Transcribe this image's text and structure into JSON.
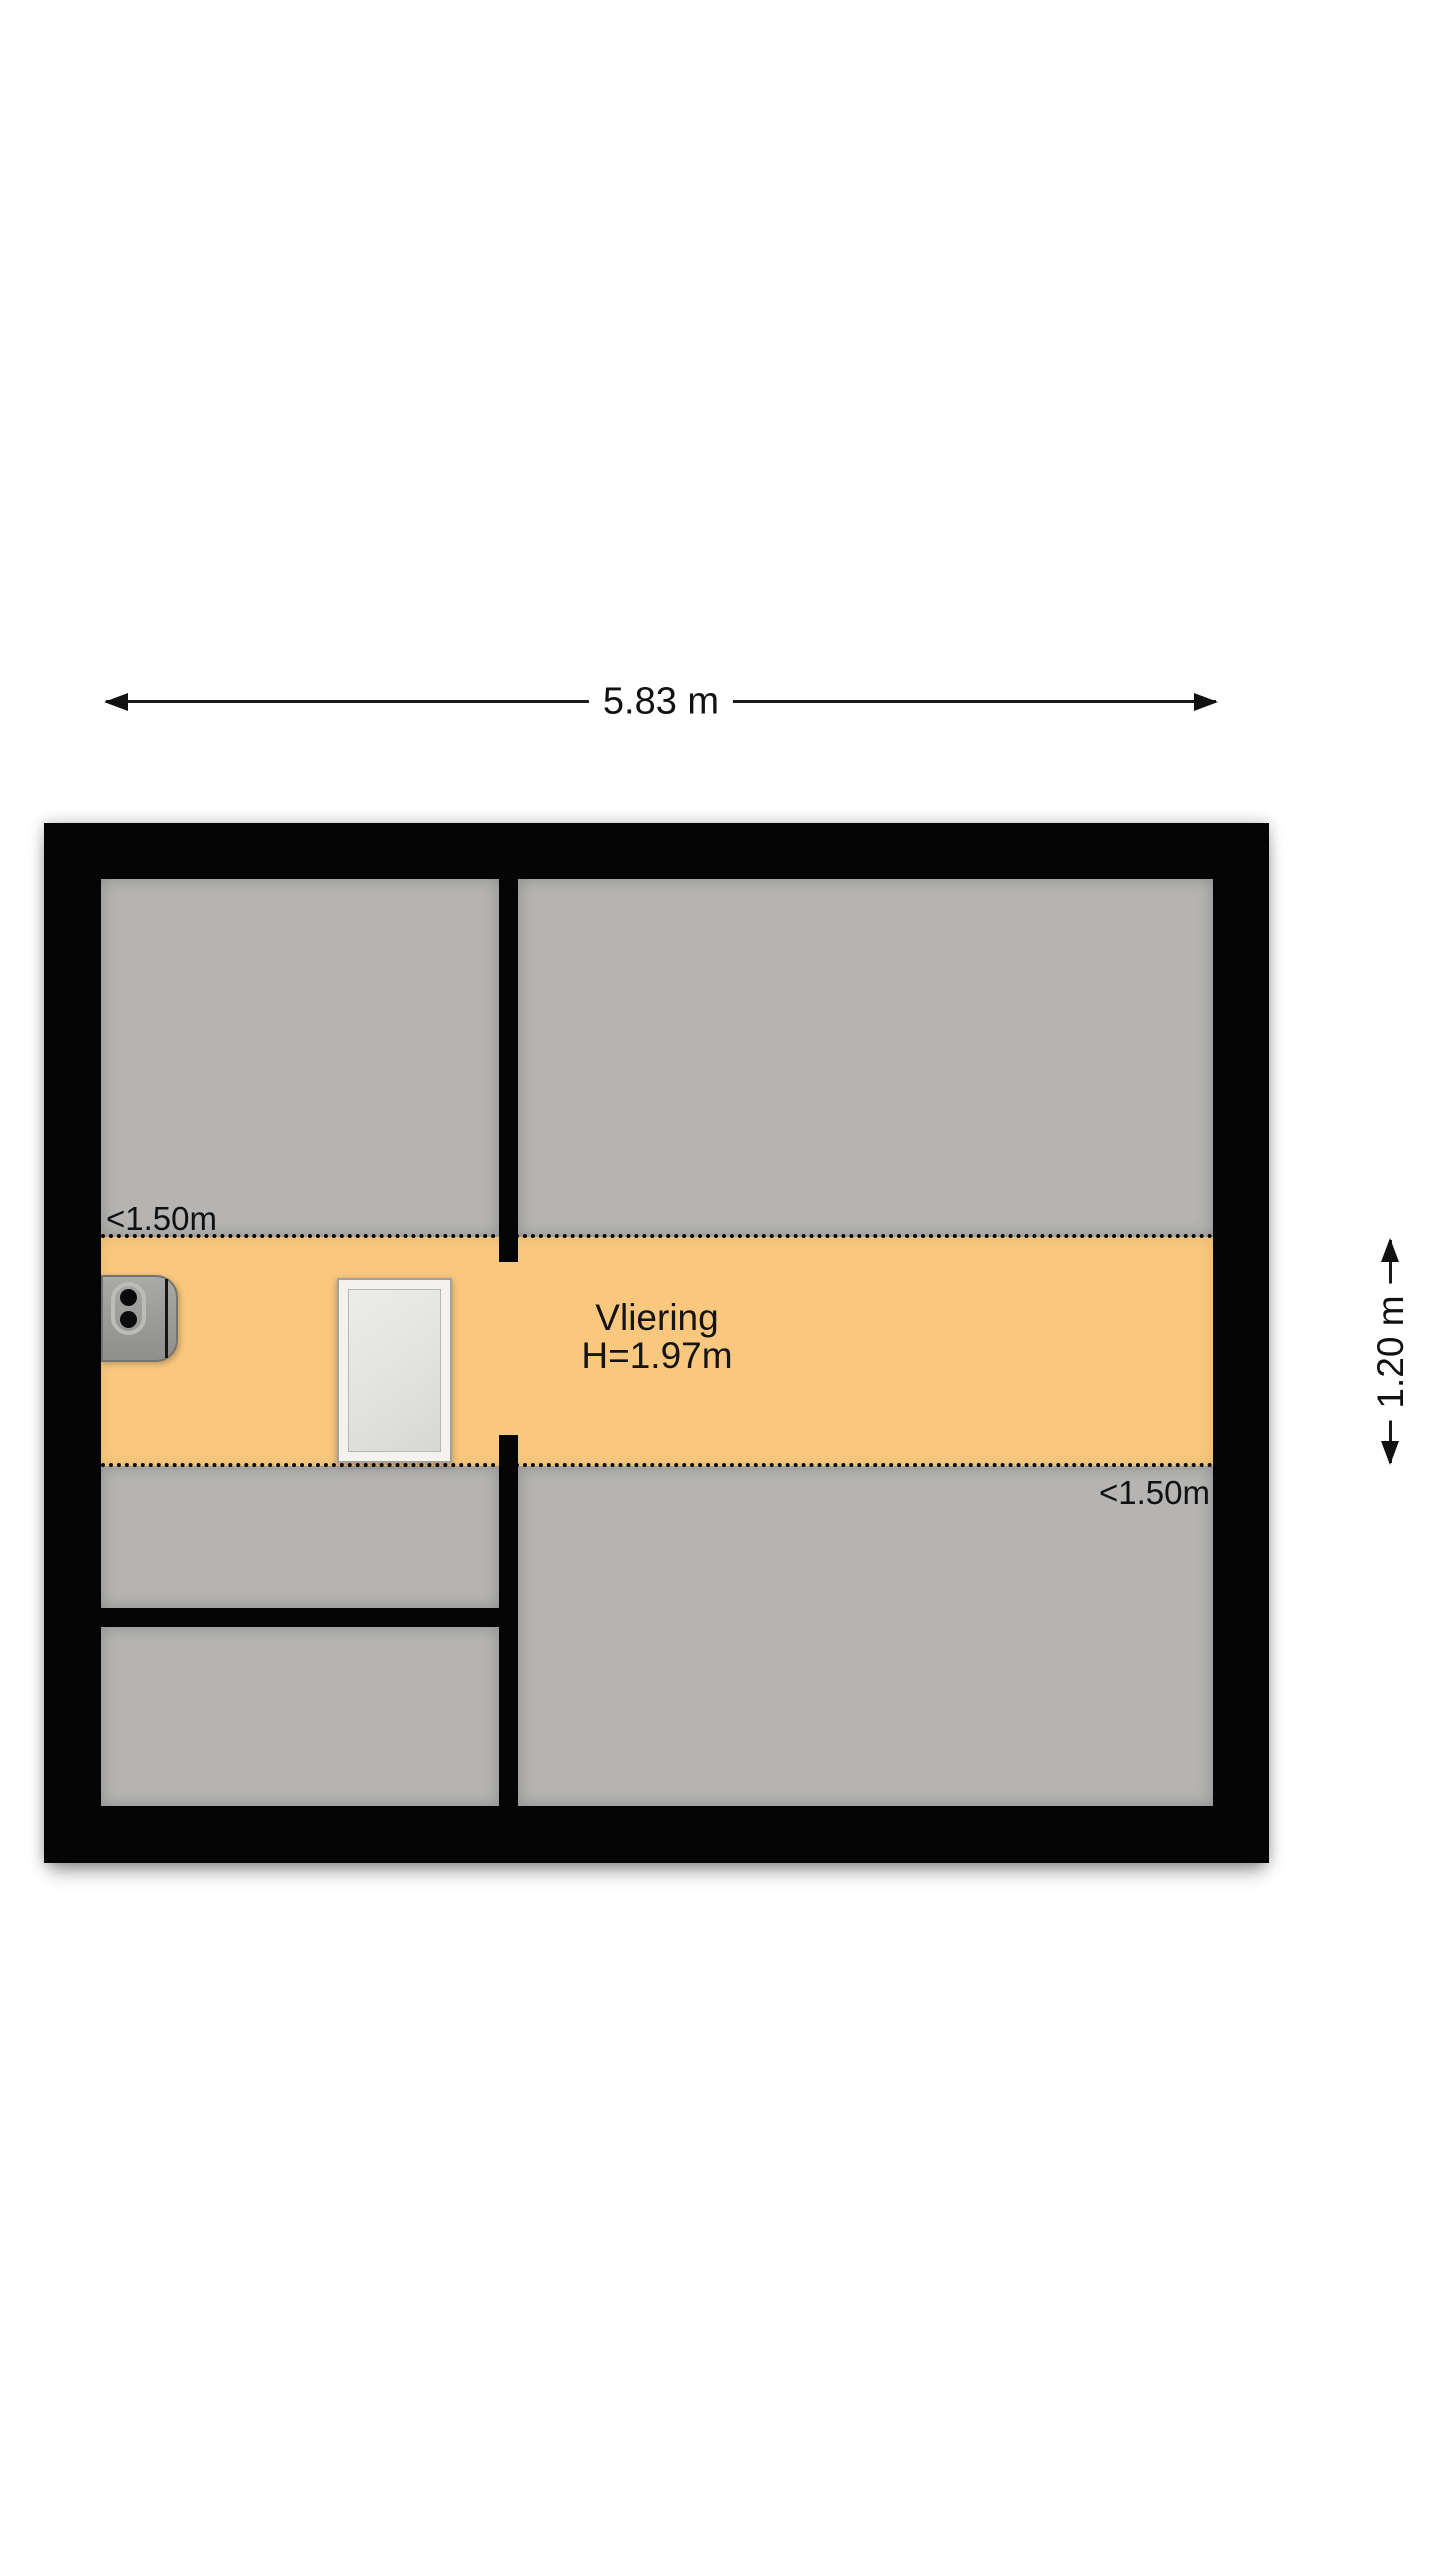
{
  "floorplan": {
    "title": "attic floor plan",
    "dimensions": {
      "top_width": "5.83 m",
      "right_depth": "1.20 m"
    },
    "height_markers": {
      "top_left": "<1.50m",
      "bottom_right": "<1.50m"
    },
    "room": {
      "name": "Vliering",
      "ceiling_height": "H=1.97m"
    },
    "symbols": {
      "boiler": "boiler-unit",
      "hatch": "loft-hatch"
    },
    "colors": {
      "wall": "#050505",
      "room_fill": "#b5b4b2",
      "low_headroom_zone": "#f9c87e",
      "background": "#ffffff",
      "hatch_frame": "#f3f2ef"
    }
  }
}
